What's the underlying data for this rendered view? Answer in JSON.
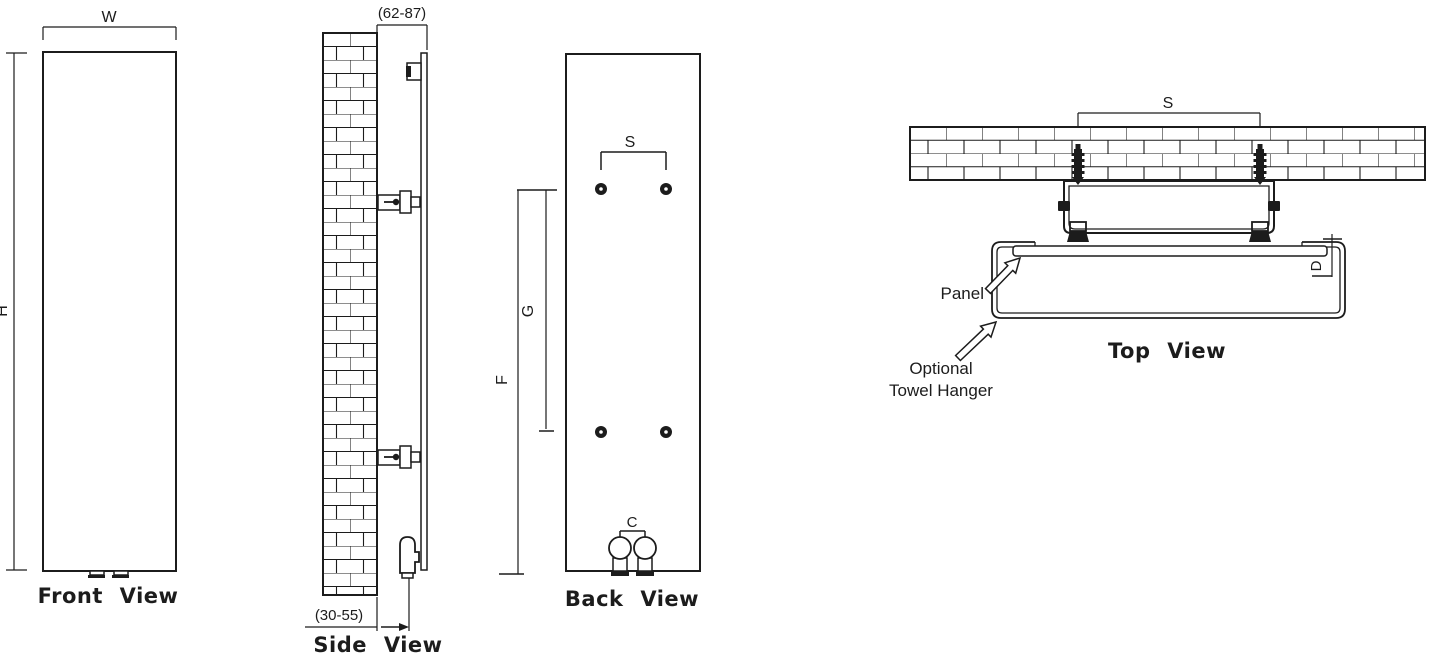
{
  "colors": {
    "line": "#1c1c1c",
    "background": "#ffffff"
  },
  "front_view": {
    "title": "Front View",
    "dim_w": "W",
    "dim_h": "H"
  },
  "side_view": {
    "title": "Side View",
    "dim_wall_to_panel": "(62-87)",
    "dim_wall_to_pipe": "(30-55)"
  },
  "back_view": {
    "title": "Back View",
    "dim_bracket_spacing": "S",
    "dim_hole_spacing": "G",
    "dim_hole_to_bottom": "F",
    "dim_connection_spacing": "C"
  },
  "top_view": {
    "title": "Top View",
    "dim_anchor_spacing": "S",
    "dim_depth": "D",
    "label_panel": "Panel",
    "label_optional": "Optional",
    "label_towel_hanger": "Towel Hanger"
  }
}
